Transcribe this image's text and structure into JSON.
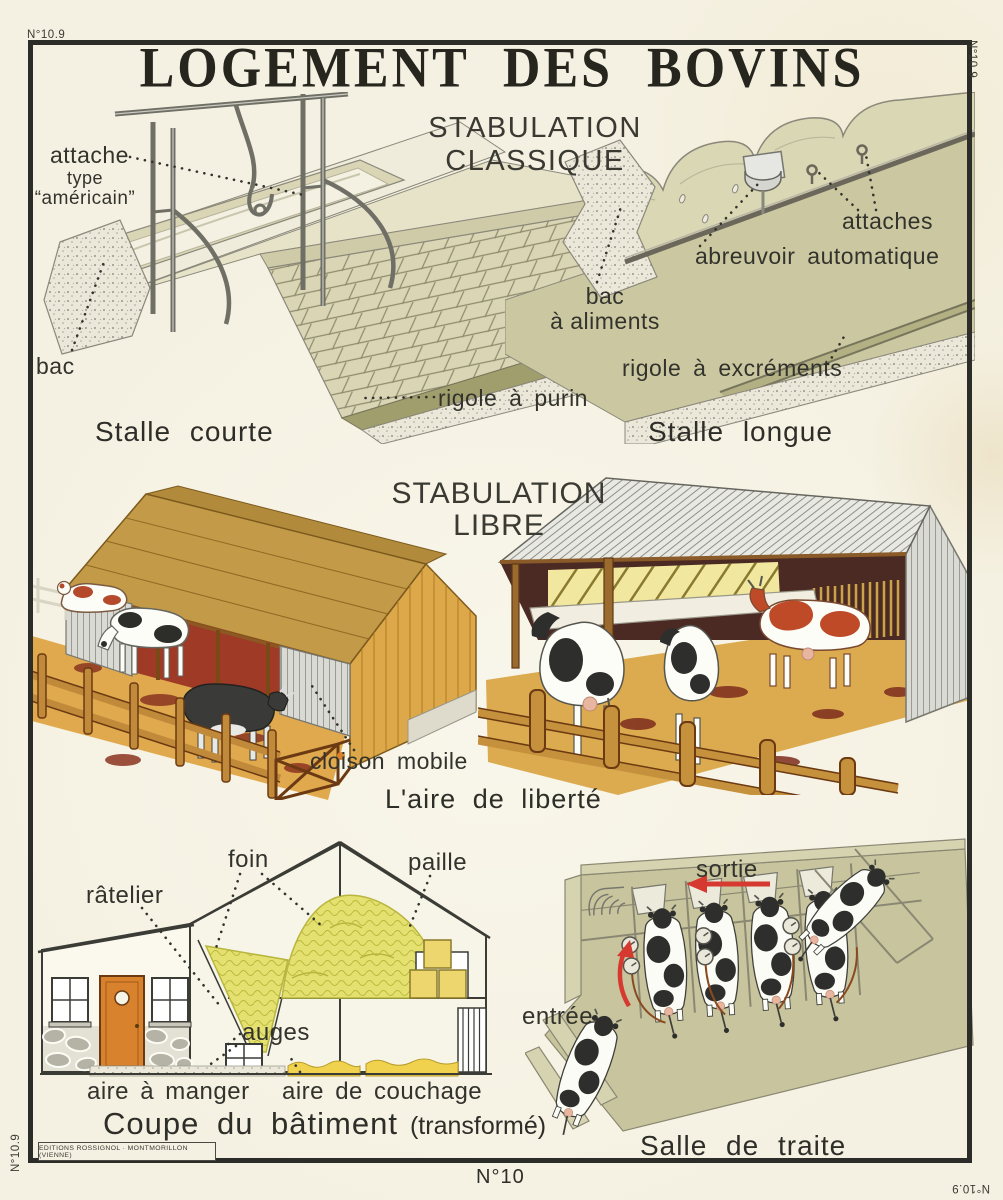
{
  "page": {
    "plate_mark": "N°10.9",
    "sheet_number": "N°10",
    "publisher": "EDITIONS ROSSIGNOL · MONTMORILLON (VIENNE)",
    "colors": {
      "paper": "#f5f1e2",
      "ink": "#2e2e29",
      "accent_red": "#d6392f",
      "roof_ochre": "#c39a47",
      "straw": "#e0a94e",
      "olive": "#cbc8a1",
      "hay": "#e4e170",
      "door_orange": "#d8822e",
      "interior_red": "#9e3a26"
    }
  },
  "header": {
    "title": "LOGEMENT DES BOVINS",
    "subtitle": "STABULATION CLASSIQUE"
  },
  "stalle_courte": {
    "caption": "Stalle courte",
    "label_attache": "attache",
    "label_attache_type": "type",
    "label_attache_type2": "“américain”",
    "label_bac": "bac",
    "label_rigole": "rigole à purin"
  },
  "stalle_longue": {
    "caption": "Stalle longue",
    "label_attaches": "attaches",
    "label_abreuvoir": "abreuvoir automatique",
    "label_bac_1": "bac",
    "label_bac_2": "à aliments",
    "label_rigole": "rigole à excréments"
  },
  "stabulation_libre": {
    "title_1": "STABULATION",
    "title_2": "LIBRE",
    "caption": "L'aire de liberté",
    "label_cloison": "cloison mobile"
  },
  "coupe": {
    "caption": "Coupe du bâtiment",
    "caption_note": "(transformé)",
    "label_foin": "foin",
    "label_paille": "paille",
    "label_ratelier": "râtelier",
    "label_auges": "auges",
    "label_aire_manger": "aire à manger",
    "label_aire_couchage": "aire de couchage"
  },
  "salle_traite": {
    "caption": "Salle de traite",
    "label_sortie": "sortie",
    "label_entree": "entrée"
  }
}
